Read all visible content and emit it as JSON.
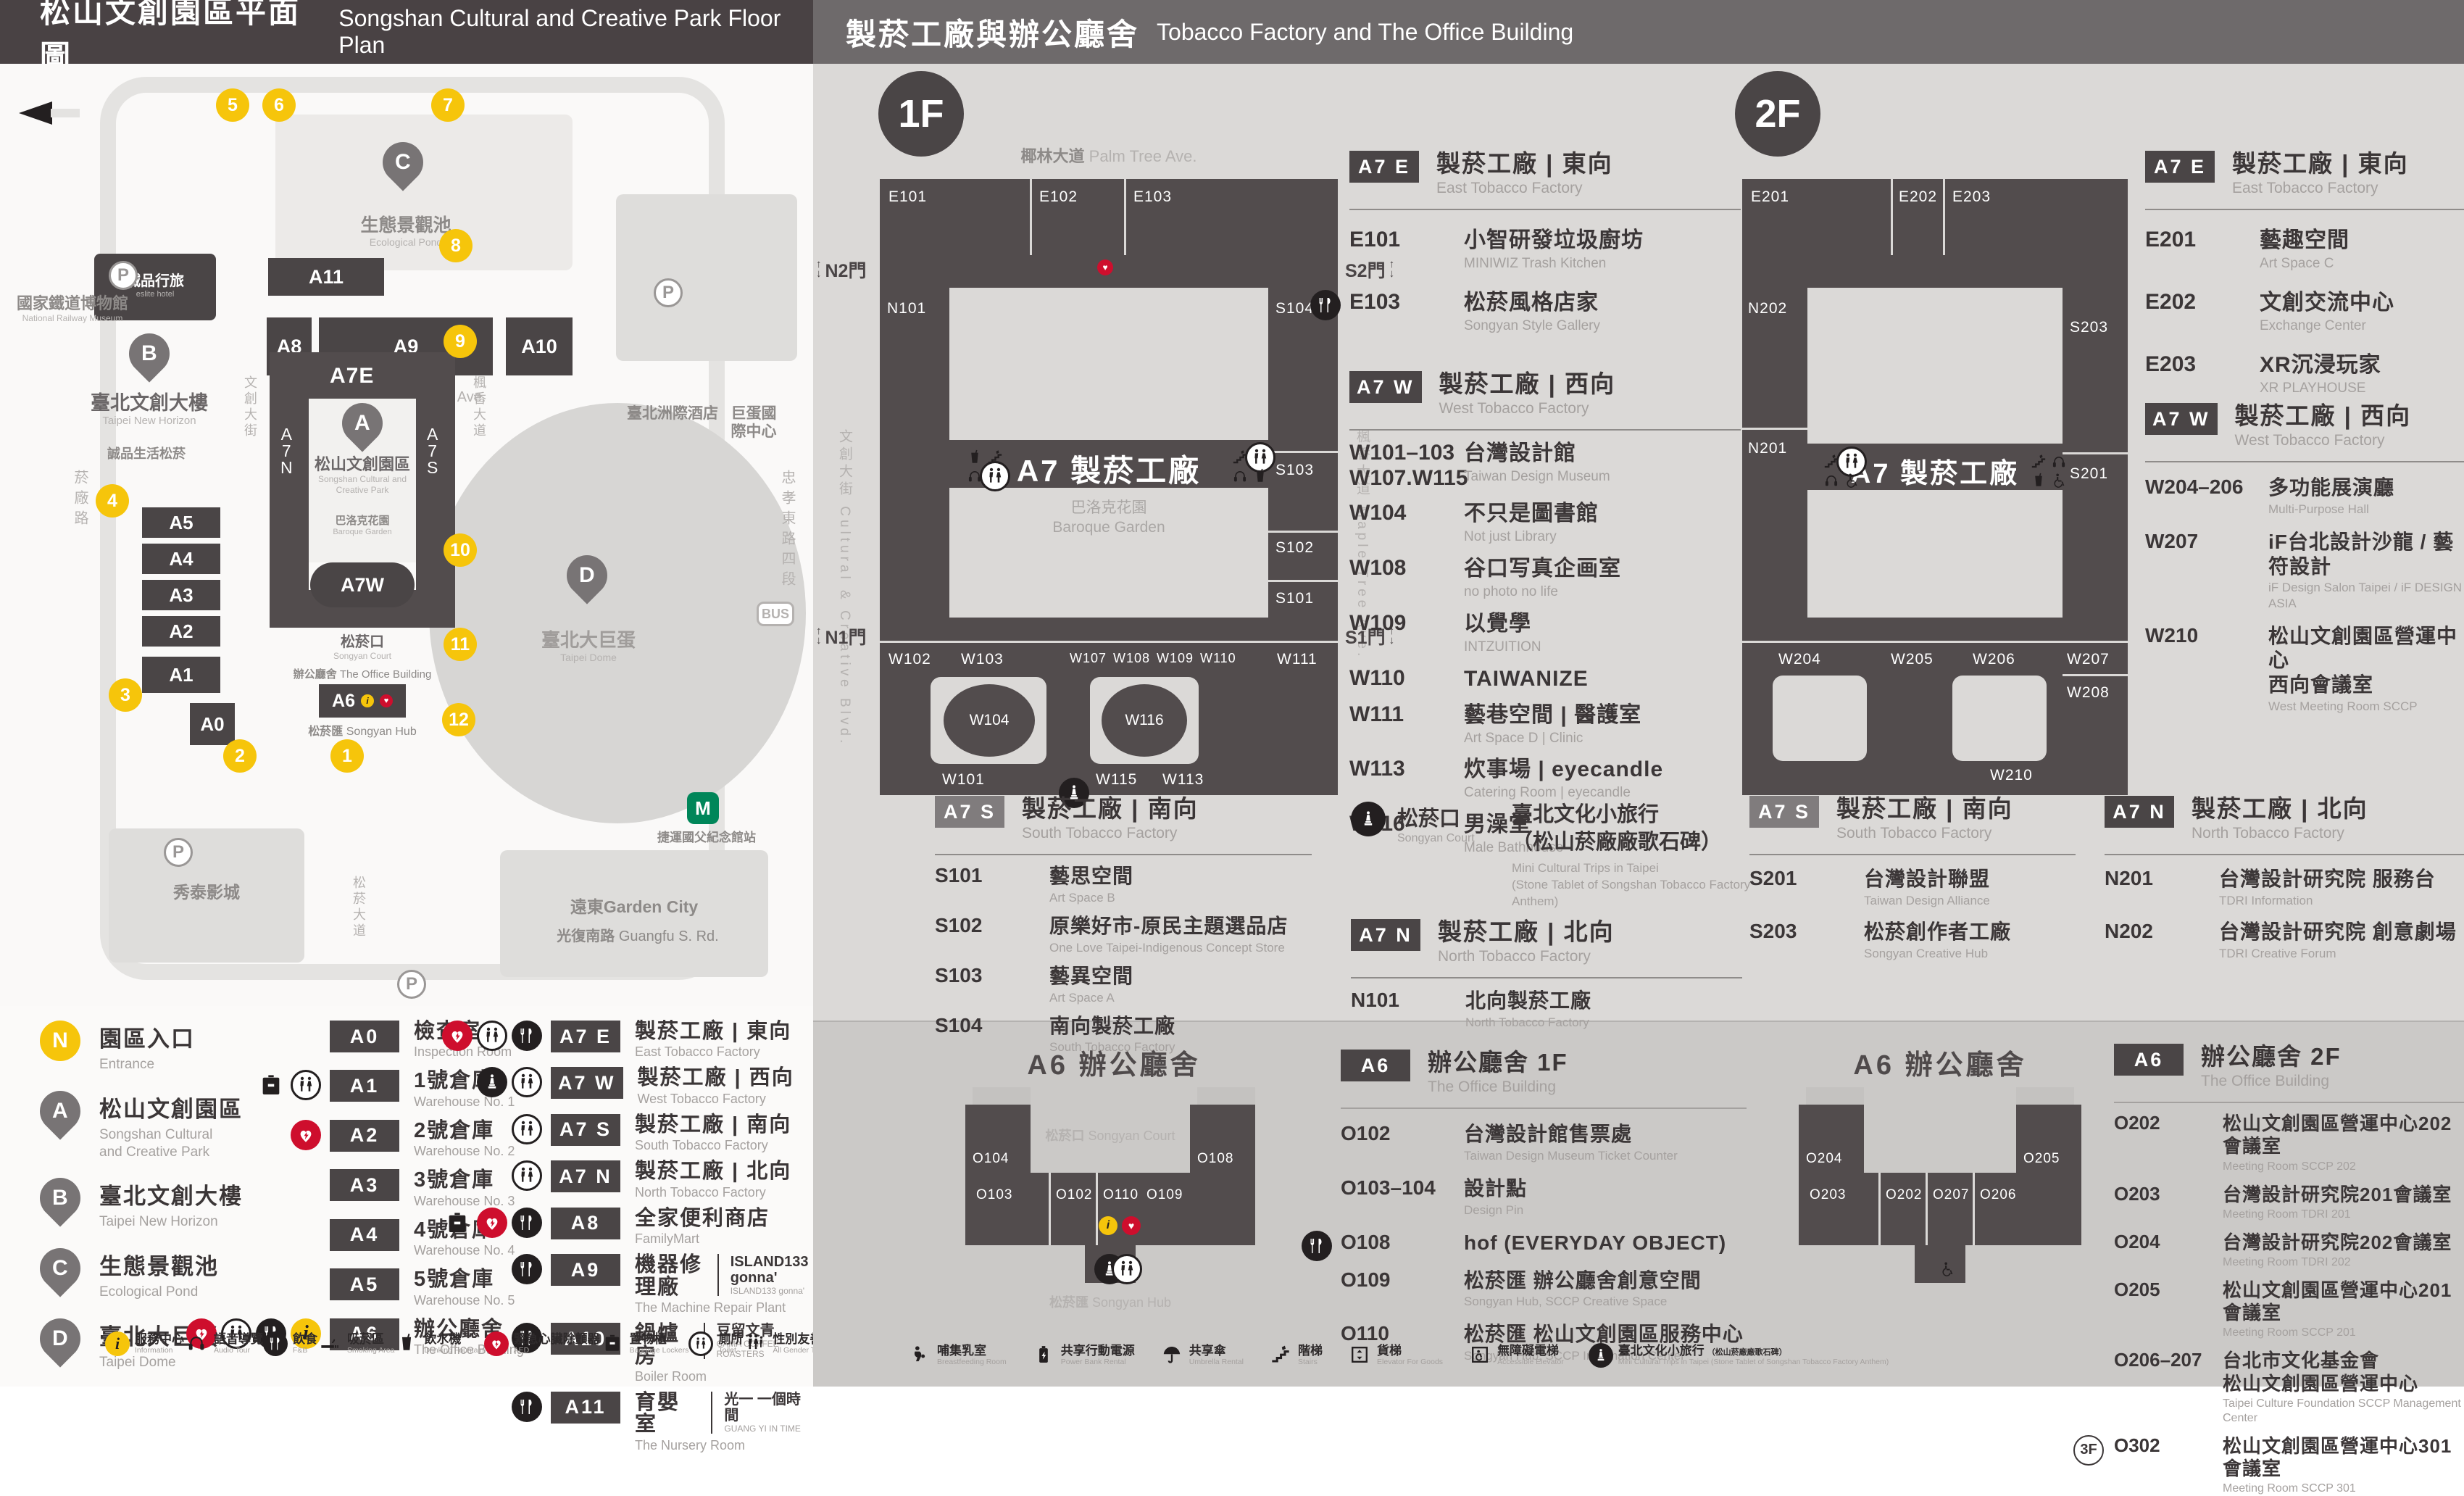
{
  "headers": {
    "left_zh": "松山文創園區平面圖",
    "left_en": "Songshan Cultural and Creative Park Floor Plan",
    "right_zh": "製菸工廠與辦公廳舍",
    "right_en": "Tobacco Factory and The Office Building"
  },
  "map": {
    "entrances": [
      "1",
      "2",
      "3",
      "4",
      "5",
      "6",
      "7",
      "8",
      "9",
      "10",
      "11",
      "12"
    ],
    "pins": {
      "a": "A",
      "b": "B",
      "c": "C",
      "d": "D"
    },
    "buildings": {
      "a11": "A11",
      "a8": "A8",
      "a9": "A9",
      "a10": "A10",
      "a7e": "A7E",
      "a7w": "A7W",
      "a7n": "A\n7\nN",
      "a7s": "A\n7\nS",
      "a6": "A6",
      "a0": "A0",
      "a5": "A5",
      "a4": "A4",
      "a3": "A3",
      "a2": "A2",
      "a1": "A1",
      "p": "P"
    },
    "labels": {
      "railway_zh": "國家鐵道博物館",
      "railway_en": "National Railway Museum",
      "eslite_hotel_zh": "誠品行旅",
      "eslite_hotel_en": "eslite hotel",
      "new_horizon_zh": "臺北文創大樓",
      "new_horizon_en": "Taipei New Horizon",
      "eslite_spectrum_zh": "誠品生活松菸",
      "pond_zh": "生態景觀池",
      "pond_en": "Ecological Pond",
      "palm_zh": "椰林大道",
      "palm_en": "Palm Tree Ave.",
      "park_zh": "松山文創園區",
      "park_en": "Songshan Cultural and\nCreative Park",
      "baroque_zh": "巴洛克花園",
      "baroque_en": "Baroque Garden",
      "court_zh": "松菸口",
      "court_en": "Songyan Court",
      "office_zh": "辦公廳舍",
      "office_en": "The Office Building",
      "hub_zh": "松菸匯",
      "hub_en": "Songyan Hub",
      "dome_zh": "臺北大巨蛋",
      "dome_en": "Taipei Dome",
      "icc_zh": "臺北洲際酒店",
      "dome_icc_zh": "巨蛋國際中心",
      "showtime_zh": "秀泰影城",
      "garden_city_zh": "遠東Garden City",
      "mrt_zh": "捷運國父紀念館站",
      "guangfu_zh": "光復南路",
      "guangfu_en": "Guangfu S. Rd.",
      "zhongxiao_zh": "忠孝東路四段",
      "yanchang_zh": "菸廠路",
      "cc_blvd_zh": "文創大街",
      "cc_blvd_en": "Cultural & Creative Blvd.",
      "maple_zh": "楓香大道",
      "maple_en": "Maple Tree Ave.",
      "songyan_ave_zh": "松菸大道",
      "songyan_ave_en": "Songyan Ave."
    }
  },
  "legend": {
    "points": [
      {
        "sym": "N",
        "is_circle": true,
        "zh": "園區入口",
        "en": "Entrance"
      },
      {
        "sym": "A",
        "is_pin": true,
        "zh": "松山文創園區",
        "en": "Songshan Cultural\nand Creative Park"
      },
      {
        "sym": "B",
        "is_pin": true,
        "zh": "臺北文創大樓",
        "en": "Taipei New Horizon"
      },
      {
        "sym": "C",
        "is_pin": true,
        "zh": "生態景觀池",
        "en": "Ecological Pond"
      },
      {
        "sym": "D",
        "is_pin": true,
        "zh": "臺北大巨蛋",
        "en": "Taipei Dome"
      }
    ],
    "warehouses": [
      {
        "badge": "A0",
        "zh": "檢查室",
        "en": "Inspection Room",
        "icons": []
      },
      {
        "badge": "A1",
        "zh": "1號倉庫",
        "en": "Warehouse No. 1",
        "icons": [
          "locker",
          "toilet"
        ]
      },
      {
        "badge": "A2",
        "zh": "2號倉庫",
        "en": "Warehouse No. 2",
        "icons": [
          "aed"
        ]
      },
      {
        "badge": "A3",
        "zh": "3號倉庫",
        "en": "Warehouse No. 3",
        "icons": []
      },
      {
        "badge": "A4",
        "zh": "4號倉庫",
        "en": "Warehouse No. 4",
        "icons": []
      },
      {
        "badge": "A5",
        "zh": "5號倉庫",
        "en": "Warehouse No. 5",
        "icons": []
      },
      {
        "badge": "A6",
        "zh": "辦公廳舍",
        "en": "The Office Building",
        "icons": [
          "aed",
          "toilet",
          "fnb",
          "info"
        ]
      }
    ],
    "factories": [
      {
        "badge": "A7 E",
        "zh": "製菸工廠 | 東向",
        "en": "East Tobacco Factory",
        "icons": [
          "aed",
          "toilet",
          "fnb"
        ]
      },
      {
        "badge": "A7 W",
        "zh": "製菸工廠 | 西向",
        "en": "West Tobacco Factory",
        "icons": [
          "statue",
          "toilet"
        ]
      },
      {
        "badge": "A7 S",
        "zh": "製菸工廠 | 南向",
        "en": "South Tobacco Factory",
        "icons": [
          "toilet"
        ]
      },
      {
        "badge": "A7 N",
        "zh": "製菸工廠 | 北向",
        "en": "North Tobacco Factory",
        "icons": [
          "toilet"
        ]
      },
      {
        "badge": "A8",
        "zh": "全家便利商店",
        "en": "FamilyMart",
        "icons": [
          "locker",
          "aed",
          "fnb"
        ]
      },
      {
        "badge": "A9",
        "zh": "機器修理廠",
        "en": "The Machine Repair Plant",
        "icons": [
          "fnb"
        ],
        "brand_zh": "ISLAND133 gonna'",
        "brand_en": "ISLAND133 gonna'"
      },
      {
        "badge": "A10",
        "zh": "鍋爐房",
        "en": "Boiler Room",
        "icons": [
          "fnb"
        ],
        "brand_zh": "豆留文青",
        "brand_en": "CAMA COFFEE ROASTERS"
      },
      {
        "badge": "A11",
        "zh": "育嬰室",
        "en": "The Nursery Room",
        "icons": [
          "fnb"
        ],
        "brand_zh": "光一 一個時間",
        "brand_en": "GUANG YI IN TIME"
      }
    ]
  },
  "facilities_left": [
    {
      "icon": "info",
      "zh": "服務中心",
      "en": "Information"
    },
    {
      "icon": "audio",
      "zh": "語音導覽",
      "en": "Audio Tour"
    },
    {
      "icon": "fnb",
      "zh": "飲食",
      "en": "F&B"
    },
    {
      "icon": "smoking",
      "zh": "吸菸區",
      "en": "Smoking Area"
    },
    {
      "icon": "water",
      "zh": "飲水機",
      "en": "Drinking Fountain"
    },
    {
      "icon": "aed",
      "zh": "緊急心臟除顫器",
      "en": "AED"
    },
    {
      "icon": "locker",
      "zh": "置物櫃",
      "en": "Baggage Lockers"
    },
    {
      "icon": "toilet",
      "zh": "廁所",
      "en": "Toilet"
    },
    {
      "icon": "all-gender",
      "zh": "性別友善廁所",
      "en": "All Gender Toilet"
    },
    {
      "icon": "men",
      "zh": "男廁",
      "en": "Men's Toilet"
    },
    {
      "icon": "women",
      "zh": "女廁",
      "en": "Women's Toilet"
    },
    {
      "icon": "wheelchair",
      "zh": "無障礙廁所",
      "en": "Accessible Toilet"
    }
  ],
  "facilities_right": [
    {
      "icon": "breastfeeding",
      "zh": "哺集乳室",
      "en": "Breastfeeding Room"
    },
    {
      "icon": "power",
      "zh": "共享行動電源",
      "en": "Power Bank Rental"
    },
    {
      "icon": "umbrella",
      "zh": "共享傘",
      "en": "Umbrella Rental"
    },
    {
      "icon": "stairs",
      "zh": "階梯",
      "en": "Stairs"
    },
    {
      "icon": "cargo-lift",
      "zh": "貨梯",
      "en": "Elevator For Goods"
    },
    {
      "icon": "accessible-lift",
      "zh": "無障礙電梯",
      "en": "Accessible Elevator"
    },
    {
      "icon": "statue",
      "zh": "臺北文化小旅行",
      "extra": "（松山菸廠廠歌石碑）",
      "en": "Mini Cultural Trips in Taipei",
      "extra_en": "(Stone Tablet of Songshan Tobacco Factory Anthem)"
    }
  ],
  "floor1": {
    "badge": "1F",
    "plan": {
      "street_top_zh": "椰林大道",
      "street_top_en": "Palm Tree Ave.",
      "street_left": "文創大街 Cultural & Creative Blvd.",
      "street_right": "楓香大道 Maple Tree Ave.",
      "gate_n2": "N2門",
      "gate_s2": "S2門",
      "gate_n1": "N1門",
      "gate_s1": "S1門",
      "center": "A7 製菸工廠",
      "garden": "巴洛克花園\nBaroque Garden",
      "rooms": {
        "e101": "E101",
        "e102": "E102",
        "e103": "E103",
        "n101": "N101",
        "s101": "S101",
        "s102": "S102",
        "s103": "S103",
        "s104": "S104",
        "w101": "W101",
        "w102": "W102",
        "w103": "W103",
        "w104": "W104",
        "w107": "W107",
        "w108": "W108",
        "w109": "W109",
        "w110": "W110",
        "w111": "W111",
        "w113": "W113",
        "w115": "W115",
        "w116": "W116"
      }
    },
    "sections": [
      {
        "badge": "A7 E",
        "zh": "製菸工廠 | 東向",
        "en": "East Tobacco Factory",
        "rooms": [
          {
            "code": "E101",
            "zh": "小智研發垃圾廚坊",
            "en": "MINIWIZ Trash Kitchen",
            "icons": []
          },
          {
            "code": "E103",
            "zh": "松菸風格店家",
            "en": "Songyan Style Gallery",
            "icons": [
              "fnb"
            ]
          }
        ]
      },
      {
        "badge": "A7 W",
        "zh": "製菸工廠 | 西向",
        "en": "West Tobacco Factory",
        "rooms": [
          {
            "code": "W101–103\nW107.W115",
            "zh": "台灣設計館",
            "en": "Taiwan Design Museum",
            "icons": []
          },
          {
            "code": "W104",
            "zh": "不只是圖書館",
            "en": "Not just Library",
            "icons": []
          },
          {
            "code": "W108",
            "zh": "谷口写真企画室",
            "en": "no photo no life",
            "icons": []
          },
          {
            "code": "W109",
            "zh": "以覺學",
            "en": "INTZUITION",
            "icons": []
          },
          {
            "code": "W110",
            "zh": "TAIWANIZE",
            "en": "",
            "icons": []
          },
          {
            "code": "W111",
            "zh": "藝巷空間 | 醫護室",
            "en": "Art Space D | Clinic",
            "icons": []
          },
          {
            "code": "W113",
            "zh": "炊事場 | eyecandle",
            "en": "Catering Room | eyecandle",
            "icons": []
          },
          {
            "code": "W116",
            "zh": "男澡堂",
            "en": "Male Bathhouse",
            "icons": []
          }
        ]
      },
      {
        "badge": "A7 S",
        "zh": "製菸工廠 | 南向",
        "en": "South Tobacco Factory",
        "rooms": [
          {
            "code": "S101",
            "zh": "藝思空間",
            "en": "Art Space B",
            "icons": []
          },
          {
            "code": "S102",
            "zh": "原樂好市-原民主題選品店",
            "en": "One Love Taipei-Indigenous Concept Store",
            "icons": []
          },
          {
            "code": "S103",
            "zh": "藝異空間",
            "en": "Art Space A",
            "icons": []
          },
          {
            "code": "S104",
            "zh": "南向製菸工廠",
            "en": "South Tobacco Factory",
            "icons": []
          }
        ]
      },
      {
        "badge": "A7 N",
        "zh": "製菸工廠 | 北向",
        "en": "North Tobacco Factory",
        "rooms": [
          {
            "code": "N101",
            "zh": "北向製菸工廠",
            "en": "North Tobacco Factory",
            "icons": []
          }
        ]
      }
    ],
    "court": {
      "code_zh": "松菸口",
      "code_en": "Songyan Court",
      "zh": "臺北文化小旅行\n（松山菸廠廠歌石碑）",
      "en": "Mini Cultural Trips in Taipei\n(Stone Tablet of Songshan Tobacco Factory Anthem)"
    }
  },
  "floor2": {
    "badge": "2F",
    "plan": {
      "center": "A7 製菸工廠",
      "rooms": {
        "e201": "E201",
        "e202": "E202",
        "e203": "E203",
        "n201": "N201",
        "n202": "N202",
        "s201": "S201",
        "s203": "S203",
        "w204": "W204",
        "w205": "W205",
        "w206": "W206",
        "w207": "W207",
        "w208": "W208",
        "w210": "W210"
      }
    },
    "sections": [
      {
        "badge": "A7 E",
        "zh": "製菸工廠 | 東向",
        "en": "East Tobacco Factory",
        "rooms": [
          {
            "code": "E201",
            "zh": "藝趣空間",
            "en": "Art Space C",
            "icons": []
          },
          {
            "code": "E202",
            "zh": "文創交流中心",
            "en": "Exchange Center",
            "icons": []
          },
          {
            "code": "E203",
            "zh": "XR沉浸玩家",
            "en": "XR PLAYHOUSE",
            "icons": []
          }
        ]
      },
      {
        "badge": "A7 W",
        "zh": "製菸工廠 | 西向",
        "en": "West Tobacco Factory",
        "rooms": [
          {
            "code": "W204–206",
            "zh": "多功能展演廳",
            "en": "Multi-Purpose Hall",
            "icons": []
          },
          {
            "code": "W207",
            "zh": "iF台北設計沙龍 / 藝符設計",
            "en": "iF Design Salon Taipei / iF DESIGN ASIA",
            "icons": []
          },
          {
            "code": "W210",
            "zh": "松山文創園區營運中心\n西向會議室",
            "en": "West Meeting Room SCCP",
            "icons": []
          }
        ]
      },
      {
        "badge": "A7 S",
        "zh": "製菸工廠 | 南向",
        "en": "South Tobacco Factory",
        "rooms": [
          {
            "code": "S201",
            "zh": "台灣設計聯盟",
            "en": "Taiwan Design Alliance",
            "icons": []
          },
          {
            "code": "S203",
            "zh": "松菸創作者工廠",
            "en": "Songyan Creative Hub",
            "icons": []
          }
        ]
      },
      {
        "badge": "A7 N",
        "zh": "製菸工廠 | 北向",
        "en": "North Tobacco Factory",
        "rooms": [
          {
            "code": "N201",
            "zh": "台灣設計研究院 服務台",
            "en": "TDRI Information",
            "icons": []
          },
          {
            "code": "N202",
            "zh": "台灣設計研究院 創意劇場",
            "en": "TDRI Creative Forum",
            "icons": []
          }
        ]
      }
    ]
  },
  "a6f1": {
    "badge": "A6",
    "title_zh": "辦公廳舍 1F",
    "title_en": "The Office Building",
    "plan_title": "A6 辦公廳舍",
    "court_zh": "松菸口",
    "court_en": "Songyan Court",
    "hub_zh": "松菸匯",
    "hub_en": "Songyan Hub",
    "plan_rooms": {
      "o102": "O102",
      "o103": "O103",
      "o104": "O104",
      "o108": "O108",
      "o109": "O109",
      "o110": "O110"
    },
    "rooms": [
      {
        "code": "O102",
        "zh": "台灣設計館售票處",
        "en": "Taiwan Design Museum Ticket Counter",
        "icons": []
      },
      {
        "code": "O103–104",
        "zh": "設計點",
        "en": "Design Pin",
        "icons": []
      },
      {
        "code": "O108",
        "zh": "hof (EVERYDAY OBJECT)",
        "en": "",
        "icons": [
          "fnb"
        ]
      },
      {
        "code": "O109",
        "zh": "松菸匯 辦公廳舍創意空間",
        "en": "Songyan Hub, SCCP Creative Space",
        "icons": []
      },
      {
        "code": "O110",
        "zh": "松菸匯 松山文創園區服務中心",
        "en": "Songyan Hub, SCCP Information Center",
        "icons": []
      }
    ]
  },
  "a6f2": {
    "badge": "A6",
    "title_zh": "辦公廳舍 2F",
    "title_en": "The Office Building",
    "plan_title": "A6 辦公廳舍",
    "plan_rooms": {
      "o202": "O202",
      "o203": "O203",
      "o204": "O204",
      "o205": "O205",
      "o206": "O206",
      "o207": "O207"
    },
    "rooms": [
      {
        "code": "O202",
        "zh": "松山文創園區營運中心202會議室",
        "en": "Meeting Room SCCP 202",
        "icons": []
      },
      {
        "code": "O203",
        "zh": "台灣設計研究院201會議室",
        "en": "Meeting Room TDRI 201",
        "icons": []
      },
      {
        "code": "O204",
        "zh": "台灣設計研究院202會議室",
        "en": "Meeting Room TDRI 202",
        "icons": []
      },
      {
        "code": "O205",
        "zh": "松山文創園區營運中心201會議室",
        "en": "Meeting Room SCCP 201",
        "icons": []
      },
      {
        "code": "O206–207",
        "zh": "台北市文化基金會\n松山文創園區營運中心",
        "en": "Taipei Culture Foundation SCCP Management Center",
        "icons": []
      },
      {
        "code": "O302",
        "tag": "3F",
        "zh": "松山文創園區營運中心301會議室",
        "en": "Meeting Room SCCP 301",
        "icons": []
      }
    ]
  }
}
